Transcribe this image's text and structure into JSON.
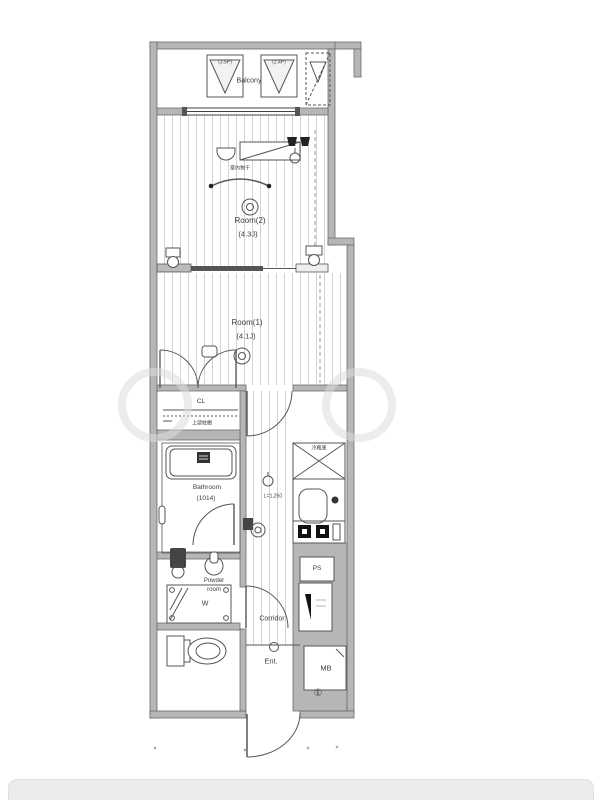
{
  "colors": {
    "wall": "#b6b6b6",
    "line": "#4a4a4a",
    "stripe": "#d3d3d3",
    "page_bg": "#ffffff",
    "bottom_bar": "#ececec"
  },
  "plan": {
    "balcony": {
      "label": "Balcony",
      "left_size": "(3.5P)",
      "right_size": "(2.4P)"
    },
    "room2": {
      "name": "Room(2)",
      "size": "(4.3J)",
      "drying_note": "室内物干"
    },
    "room1": {
      "name": "Room(1)",
      "size": "(4.1J)"
    },
    "closet": {
      "label": "CL",
      "note": "上部枕棚"
    },
    "bathroom": {
      "name": "Bathroom",
      "size": "(1014)"
    },
    "powder": {
      "name_line1": "Powder",
      "name_line2": "room"
    },
    "washer_label": "W",
    "kitchen": {
      "counter_length": "L=1,250",
      "fridge_label": "冷蔵庫"
    },
    "ps_label": "PS",
    "corridor_label": "Corridor",
    "entrance_label": "Ent.",
    "mb_label": "MB",
    "door_number": "①"
  }
}
